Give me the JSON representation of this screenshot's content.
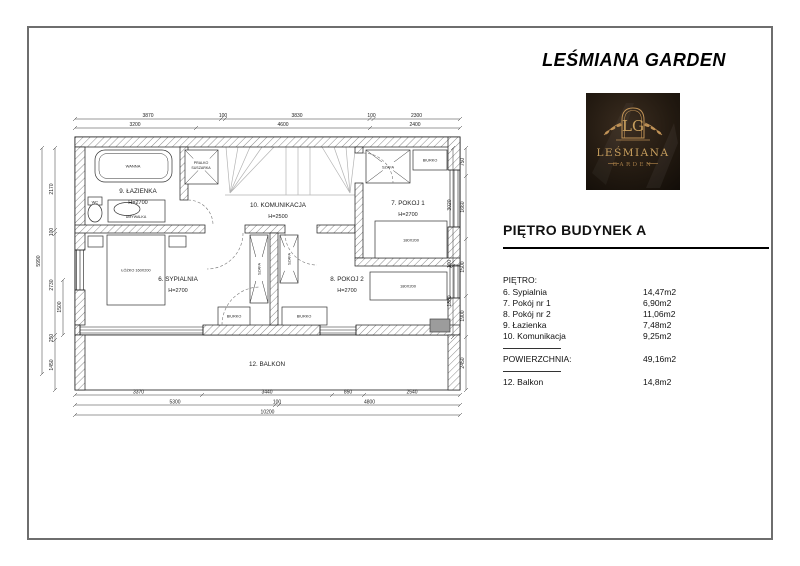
{
  "doc": {
    "title": "LEŚMIANA GARDEN"
  },
  "logo": {
    "monogram": "LG",
    "brand": "LEŚMIANA",
    "sub": "GARDEN"
  },
  "colors": {
    "gold": "#c09256",
    "logo_bg": "#171009",
    "line": "#1a1a1a"
  },
  "panel": {
    "heading": "PIĘTRO BUDYNEK A",
    "section": "PIĘTRO:",
    "rows": [
      {
        "label": "6. Sypialnia",
        "area": "14,47m2"
      },
      {
        "label": "7. Pokój nr 1",
        "area": "6,90m2"
      },
      {
        "label": "8. Pokój nr 2",
        "area": "11,06m2"
      },
      {
        "label": "9. Łazienka",
        "area": "7,48m2"
      },
      {
        "label": "10. Komunikacja",
        "area": "9,25m2"
      }
    ],
    "total_label": "POWIERZCHNIA:",
    "total_value": "49,16m2",
    "balcony_label": "12. Balkon",
    "balcony_value": "14,8m2"
  },
  "plan": {
    "rooms": {
      "lazienka": {
        "name": "9. ŁAZIENKA",
        "h": "H=2700"
      },
      "komunikacja": {
        "name": "10. KOMUNIKACJA",
        "h": "H=2500"
      },
      "pokoj1": {
        "name": "7. POKOJ 1",
        "h": "H=2700"
      },
      "sypialnia": {
        "name": "6. SYPIALNIA",
        "h": "H=2700"
      },
      "pokoj2": {
        "name": "8. POKOJ 2",
        "h": "H=2700"
      },
      "balkon": {
        "name": "12. BALKON"
      }
    },
    "furniture": {
      "wanna": "WANNA",
      "wc": "WC",
      "umywalka": "UMYWALKA",
      "pralko1": "PRALKO",
      "pralko2": "SUSZARKA",
      "szafa": "SZAFA",
      "biurko": "BIURKO",
      "lozko": "ŁÓŻKO 160X200",
      "bed180": "180X200"
    },
    "dims": {
      "top1": [
        "3870",
        "100",
        "3830",
        "100",
        "2300"
      ],
      "top2": [
        "3200",
        "4600",
        "2400"
      ],
      "bot1": [
        "3370",
        "3440",
        "850",
        "2540"
      ],
      "bot2": [
        "5300",
        "100",
        "4800"
      ],
      "bot3": [
        "10200"
      ],
      "left": [
        "5990",
        "2170",
        "100",
        "2730",
        "250",
        "1450",
        "1500"
      ],
      "right": [
        "3020",
        "100",
        "1880",
        "750",
        "1660",
        "1500",
        "1900",
        "2450"
      ]
    }
  }
}
